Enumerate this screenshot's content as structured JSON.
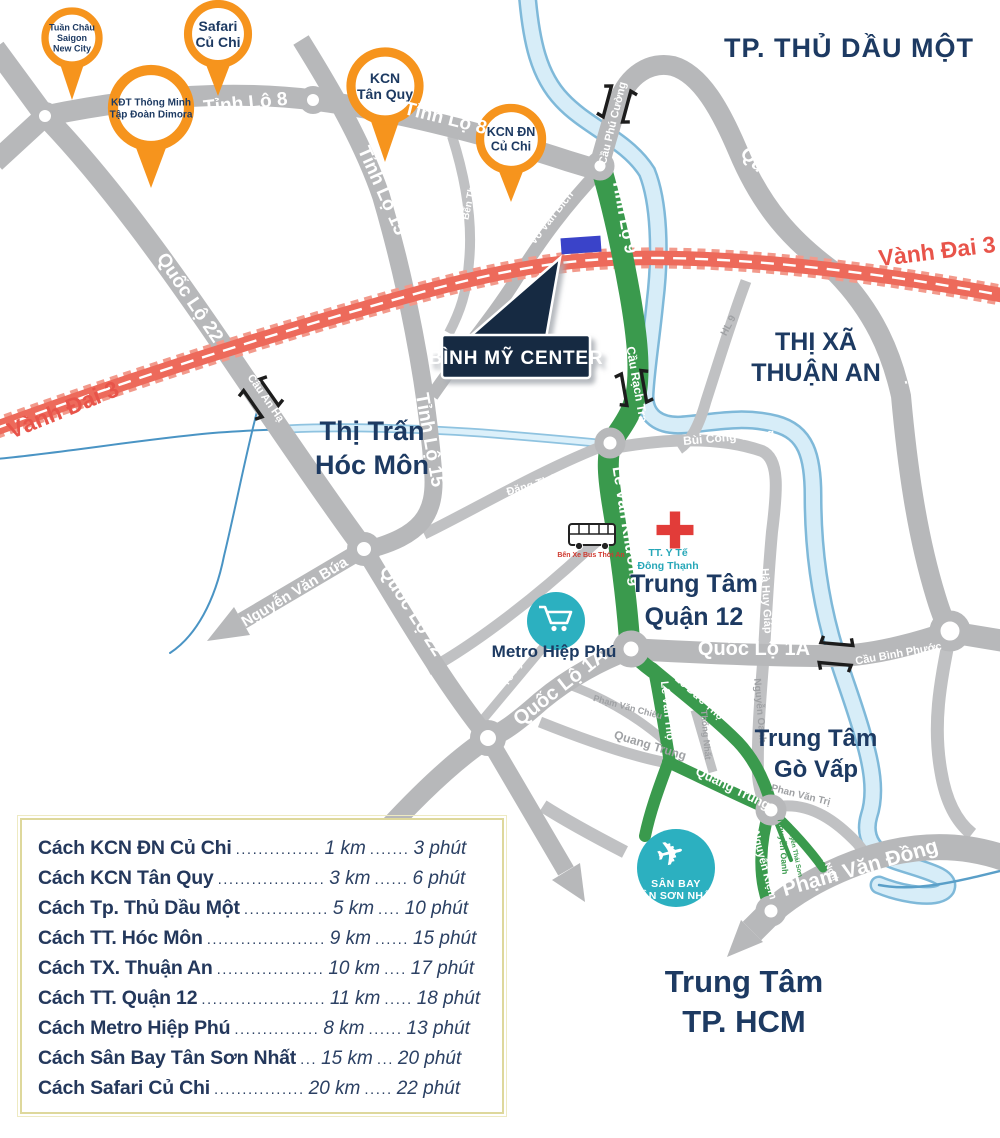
{
  "colors": {
    "road_gray": "#b7b8ba",
    "road_gray_minor": "#c0c1c3",
    "route_green": "#3a9a4d",
    "ring_road_red": "#ed6a5b",
    "ring_road_red_edge": "#f29a8c",
    "navy_text": "#1d3a62",
    "teal_poi": "#2cb0c0",
    "pin_orange": "#f6941d",
    "river_fill": "#d7edf8",
    "river_edge": "#7fb9d9",
    "creek_blue": "#4a94c4",
    "site_blue": "#3a43c9",
    "callout_bg": "#142a42",
    "medical_red": "#e23c39",
    "table_border": "#ded89c"
  },
  "callout": {
    "text": "BÌNH MỸ CENTER"
  },
  "map": {
    "area_labels": [
      {
        "id": "label-tp-thu-dau-mot",
        "x": 849,
        "y": 57,
        "fs": 27,
        "lh": 32,
        "c": "navy",
        "ls": 1,
        "lines": [
          "TP. THỦ DẦU MỘT"
        ]
      },
      {
        "id": "label-thi-xa-thuan-an",
        "x": 816,
        "y": 350,
        "fs": 25,
        "lh": 31,
        "c": "navy",
        "lines": [
          "THỊ XÃ",
          "THUẬN AN"
        ]
      },
      {
        "id": "label-thi-tran-hoc-mon",
        "x": 372,
        "y": 440,
        "fs": 27,
        "lh": 34,
        "c": "navy",
        "lines": [
          "Thị Trấn",
          "Hóc Môn"
        ]
      },
      {
        "id": "label-trung-tam-quan-12",
        "x": 694,
        "y": 592,
        "fs": 25,
        "lh": 33,
        "c": "navy",
        "lines": [
          "Trung Tâm",
          "Quận 12"
        ]
      },
      {
        "id": "label-trung-tam-go-vap",
        "x": 816,
        "y": 746,
        "fs": 24,
        "lh": 31,
        "c": "navy",
        "lines": [
          "Trung Tâm",
          "Gò Vấp"
        ]
      },
      {
        "id": "label-trung-tam-tp-hcm",
        "x": 744,
        "y": 992,
        "fs": 31,
        "lh": 40,
        "c": "navy",
        "lines": [
          "Trung Tâm",
          "TP. HCM"
        ]
      },
      {
        "id": "label-metro-hiep-phu",
        "x": 554,
        "y": 657,
        "fs": 17,
        "lh": 20,
        "c": "navy",
        "lines": [
          "Metro Hiệp Phú"
        ]
      },
      {
        "id": "label-tt-y-te-dong-thanh",
        "x": 668,
        "y": 556,
        "fs": 10.5,
        "lh": 13,
        "c": "teal",
        "lines": [
          "TT. Y Tế",
          "Đông Thạnh"
        ]
      },
      {
        "id": "label-ben-xe-bus-thoi-an",
        "x": 591,
        "y": 557,
        "fs": 7,
        "lh": 9,
        "c": "red",
        "lines": [
          "Bến Xe Bus Thới An"
        ]
      }
    ],
    "road_labels": [
      {
        "t": "Tỉnh Lộ 8",
        "x": 246,
        "y": 109,
        "r": -6,
        "fs": 19,
        "c": "w"
      },
      {
        "t": "Tỉnh Lộ 8",
        "x": 444,
        "y": 124,
        "r": 14,
        "fs": 19,
        "c": "w"
      },
      {
        "t": "Tỉnh Lộ 15",
        "x": 377,
        "y": 193,
        "r": 66,
        "fs": 19,
        "c": "w"
      },
      {
        "t": "Tỉnh Lộ 15",
        "x": 424,
        "y": 441,
        "r": 80,
        "fs": 19,
        "c": "w"
      },
      {
        "t": "Quốc Lộ 22",
        "x": 185,
        "y": 301,
        "r": 56,
        "fs": 19,
        "c": "w"
      },
      {
        "t": "Quốc Lộ 22",
        "x": 407,
        "y": 614,
        "r": 57,
        "fs": 19,
        "c": "w"
      },
      {
        "t": "Quốc Lộ 13",
        "x": 776,
        "y": 191,
        "r": 45,
        "fs": 19,
        "c": "w"
      },
      {
        "t": "Quốc Lộ 13",
        "x": 903,
        "y": 363,
        "r": 74,
        "fs": 19,
        "c": "w"
      },
      {
        "t": "Quốc Lộ 1A",
        "x": 754,
        "y": 655,
        "r": 0,
        "fs": 20,
        "c": "w"
      },
      {
        "t": "Quốc Lộ 1A",
        "x": 564,
        "y": 692,
        "r": -38,
        "fs": 20,
        "c": "w"
      },
      {
        "t": "Vành Đai 3",
        "x": 938,
        "y": 259,
        "r": -7,
        "fs": 23,
        "c": "rd"
      },
      {
        "t": "Vành Đai 3",
        "x": 66,
        "y": 417,
        "r": -22,
        "fs": 23,
        "c": "rd"
      },
      {
        "t": "Nguyễn Văn Bứa",
        "x": 297,
        "y": 596,
        "r": -31,
        "fs": 15,
        "c": "w"
      },
      {
        "t": "Lê Văn Khương",
        "x": 622,
        "y": 527,
        "r": 81,
        "fs": 16,
        "c": "w"
      },
      {
        "t": "Tỉnh Lộ 9",
        "x": 619,
        "y": 217,
        "r": 80,
        "fs": 17,
        "c": "w"
      },
      {
        "t": "Phạm Văn Đồng",
        "x": 862,
        "y": 874,
        "r": -16,
        "fs": 21,
        "c": "w"
      },
      {
        "t": "Quang Trung",
        "x": 649,
        "y": 749,
        "r": 17,
        "fs": 12,
        "c": "g"
      },
      {
        "t": "Quang Trung",
        "x": 731,
        "y": 792,
        "r": 26,
        "fs": 13,
        "c": "w"
      },
      {
        "t": "Lê Văn Thọ",
        "x": 664,
        "y": 711,
        "r": 84,
        "fs": 11,
        "c": "w"
      },
      {
        "t": "Lê Đức Thọ",
        "x": 697,
        "y": 700,
        "r": 42,
        "fs": 11,
        "c": "w"
      },
      {
        "t": "Nguyễn Kiệm",
        "x": 761,
        "y": 866,
        "r": 75,
        "fs": 11,
        "c": "w"
      },
      {
        "t": "Nguyễn Oanh",
        "x": 757,
        "y": 711,
        "r": 85,
        "fs": 10,
        "c": "g"
      },
      {
        "t": "Nguyễn Oanh",
        "x": 780,
        "y": 847,
        "r": 85,
        "fs": 8.5,
        "c": "gr"
      },
      {
        "t": "Nguyễn Thái Sơn",
        "x": 793,
        "y": 851,
        "r": 78,
        "fs": 6.5,
        "c": "gr"
      },
      {
        "t": "Nguyễn Văn Nghị",
        "x": 817,
        "y": 850,
        "r": 62,
        "fs": 8.5,
        "c": "w"
      },
      {
        "t": "Phan Văn Trị",
        "x": 800,
        "y": 798,
        "r": 14,
        "fs": 10,
        "c": "g"
      },
      {
        "t": "Phạm Văn Chiêu",
        "x": 627,
        "y": 710,
        "r": 15,
        "fs": 9,
        "c": "g"
      },
      {
        "t": "Thống Nhất",
        "x": 703,
        "y": 735,
        "r": 85,
        "fs": 9,
        "c": "g"
      },
      {
        "t": "Bùi Công Trừng",
        "x": 729,
        "y": 441,
        "r": -5,
        "fs": 12,
        "c": "w"
      },
      {
        "t": "Hà Huy Giáp",
        "x": 763,
        "y": 601,
        "r": 87,
        "fs": 11,
        "c": "w"
      },
      {
        "t": "Võ Văn Bích",
        "x": 554,
        "y": 220,
        "r": -52,
        "fs": 11,
        "c": "w"
      },
      {
        "t": "Bến Than",
        "x": 473,
        "y": 198,
        "r": -78,
        "fs": 10,
        "c": "w"
      },
      {
        "t": "HL 9",
        "x": 731,
        "y": 327,
        "r": -62,
        "fs": 10,
        "c": "g"
      },
      {
        "t": "Đặng Thúc Vịnh",
        "x": 548,
        "y": 484,
        "r": -16,
        "fs": 11,
        "c": "w"
      },
      {
        "t": "Nguyễn Ánh Thủ",
        "x": 519,
        "y": 589,
        "r": -40,
        "fs": 11,
        "c": "w"
      },
      {
        "t": "Tô Ký",
        "x": 515,
        "y": 675,
        "r": -57,
        "fs": 10,
        "c": "w"
      },
      {
        "t": "Cầu Phú Cường",
        "x": 616,
        "y": 124,
        "r": -76,
        "fs": 11,
        "c": "w"
      },
      {
        "t": "Cầu Rạch Tra",
        "x": 633,
        "y": 385,
        "r": 80,
        "fs": 12,
        "c": "w"
      },
      {
        "t": "Cầu An Hạ",
        "x": 263,
        "y": 400,
        "r": 55,
        "fs": 11,
        "c": "w"
      },
      {
        "t": "Cầu Bình Phước",
        "x": 899,
        "y": 657,
        "r": -10,
        "fs": 11,
        "c": "w"
      }
    ],
    "pins": [
      {
        "id": "pin-tuan-chau-saigon-new-city",
        "cx": 72,
        "cy": 38,
        "r": 27,
        "tip": 100,
        "fs": 9,
        "lines": [
          "Tuần Châu",
          "Saigon",
          "New City"
        ]
      },
      {
        "id": "pin-kdt-thong-minh-dimora",
        "cx": 151,
        "cy": 108,
        "r": 38,
        "tip": 188,
        "fs": 10,
        "lines": [
          "KĐT Thông Minh",
          "Tập Đoàn Dimora"
        ]
      },
      {
        "id": "pin-safari-cu-chi",
        "cx": 218,
        "cy": 34,
        "r": 30,
        "tip": 96,
        "fs": 14,
        "lines": [
          "Safari",
          "Củ Chi"
        ]
      },
      {
        "id": "pin-kcn-tan-quy",
        "cx": 385,
        "cy": 86,
        "r": 34,
        "tip": 162,
        "fs": 14,
        "lines": [
          "KCN",
          "Tân Quy"
        ]
      },
      {
        "id": "pin-kcn-dn-cu-chi",
        "cx": 511,
        "cy": 139,
        "r": 31,
        "tip": 202,
        "fs": 12.5,
        "lines": [
          "KCN ĐN",
          "Củ Chi"
        ]
      }
    ],
    "bridges": [
      {
        "id": "cau-phu-cuong",
        "x": 617,
        "y": 104,
        "rot": 15
      },
      {
        "id": "cau-rach-tra",
        "x": 634,
        "y": 388,
        "rot": -10
      },
      {
        "id": "cau-an-ha",
        "x": 261,
        "y": 398,
        "rot": -35
      },
      {
        "id": "cau-binh-phuoc",
        "x": 836,
        "y": 654,
        "rot": -85
      }
    ],
    "pois": {
      "airport": {
        "icon": "✈",
        "line1": "SÂN BAY",
        "line2": "TÂN SƠN NHẤT"
      }
    }
  },
  "distance_table": {
    "rows": [
      {
        "name": "Cách KCN ĐN Củ Chi",
        "d1": "...............",
        "km": "1 km",
        "d2": ".......",
        "min": "3 phút"
      },
      {
        "name": "Cách KCN Tân Quy",
        "d1": "...................",
        "km": "3 km",
        "d2": "......",
        "min": "6 phút"
      },
      {
        "name": "Cách Tp. Thủ Dầu Một",
        "d1": "...............",
        "km": "5 km",
        "d2": "....",
        "min": "10 phút"
      },
      {
        "name": "Cách TT. Hóc Môn",
        "d1": ".....................",
        "km": "9 km",
        "d2": "......",
        "min": "15 phút"
      },
      {
        "name": "Cách TX. Thuận An",
        "d1": "...................",
        "km": "10 km",
        "d2": "....",
        "min": "17 phút"
      },
      {
        "name": "Cách TT. Quận 12",
        "d1": "......................",
        "km": "11 km",
        "d2": ".....",
        "min": "18 phút"
      },
      {
        "name": "Cách Metro Hiệp Phú",
        "d1": "...............",
        "km": "8 km",
        "d2": "......",
        "min": "13 phút"
      },
      {
        "name": "Cách Sân Bay Tân Sơn Nhất",
        "d1": "...",
        "km": "15 km",
        "d2": "...",
        "min": "20 phút"
      },
      {
        "name": "Cách Safari Củ Chi",
        "d1": "................",
        "km": "20 km",
        "d2": ".....",
        "min": "22 phút"
      }
    ]
  }
}
